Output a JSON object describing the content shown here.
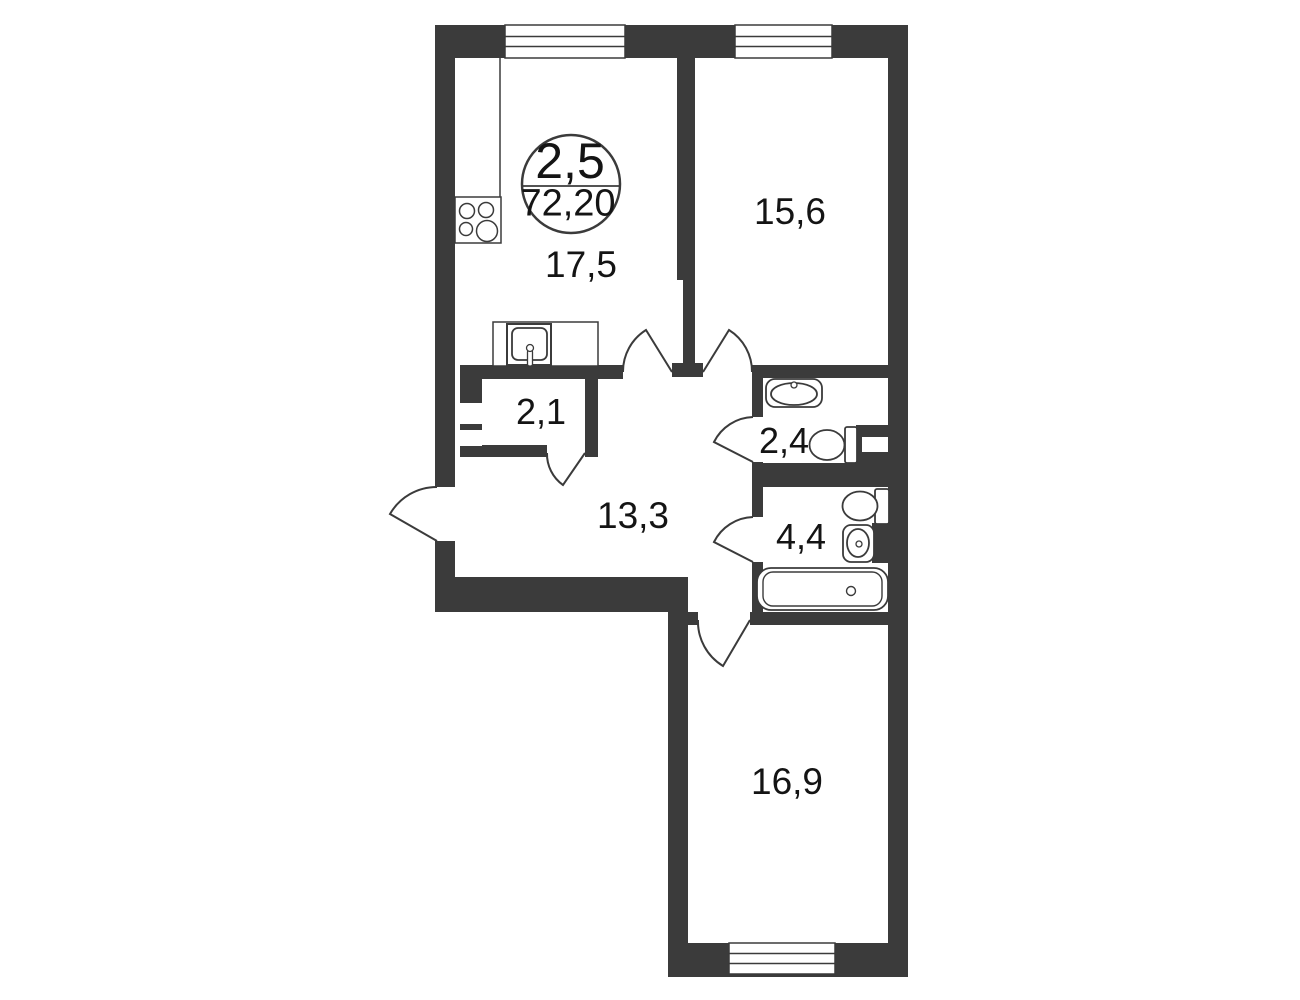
{
  "plan": {
    "badge": {
      "rooms_value": "2,5",
      "total_area_value": "72,20"
    },
    "rooms": {
      "kitchen": {
        "area": "17,5"
      },
      "bedroom": {
        "area": "15,6"
      },
      "storage": {
        "area": "2,1"
      },
      "wc": {
        "area": "2,4"
      },
      "hallway": {
        "area": "13,3"
      },
      "bathroom": {
        "area": "4,4"
      },
      "living": {
        "area": "16,9"
      }
    },
    "fixtures": [
      "stove-icon",
      "kitchen-sink-icon",
      "washbasin-icon",
      "toilet-icon",
      "toilet-icon",
      "washbasin-icon",
      "bathtub-icon"
    ],
    "colors": {
      "wall": "#3b3b3b",
      "background": "#ffffff",
      "text": "#141414"
    }
  }
}
